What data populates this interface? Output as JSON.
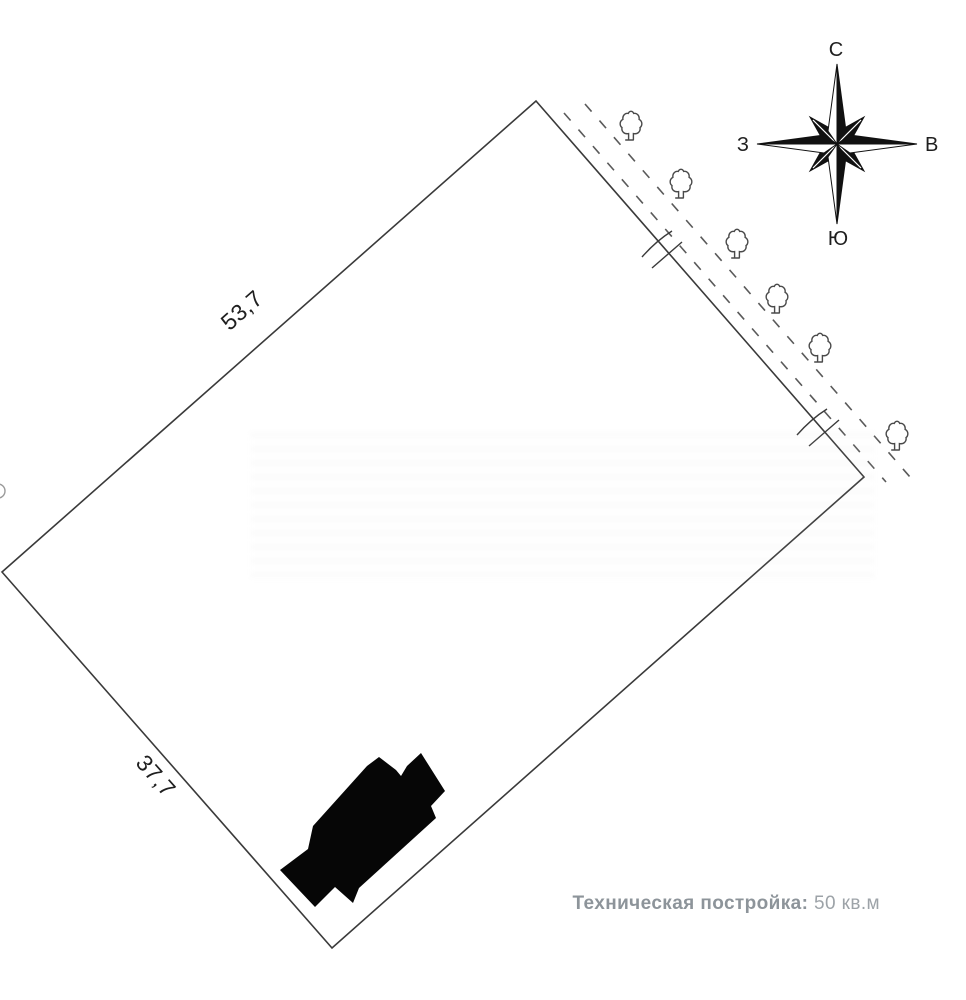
{
  "plot": {
    "dimensions": {
      "top_left_side": "53,7",
      "bottom_left_side": "37,7"
    },
    "tree_icon_count": 6
  },
  "compass": {
    "north": "С",
    "east": "В",
    "south": "Ю",
    "west": "З"
  },
  "caption": {
    "label": "Техническая постройка:",
    "value": "50 кв.м"
  },
  "colors": {
    "ink": "#1f1f1f",
    "boundary": "#3a3a3a",
    "dash": "#5a5a5a",
    "tree": "#4a4a4a",
    "building": "#060606",
    "caption-label": "#8d949a",
    "caption-value": "#9da3a8"
  }
}
